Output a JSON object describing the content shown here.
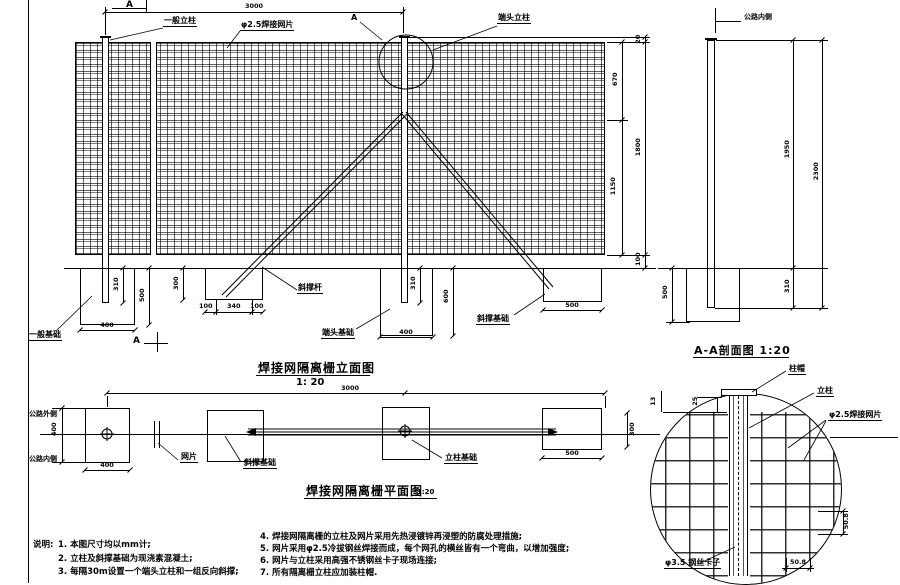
{
  "elevation": {
    "title": "焊接网隔离栅立面图",
    "scale": "1: 20",
    "span": "3000",
    "marker_a_top": "A",
    "marker_a_bottom": "A",
    "callout_a": "A",
    "post_general": "一般立柱",
    "mesh_label": "φ2.5焊接网片",
    "end_post": "端头立柱",
    "d20": "20",
    "d670": "670",
    "d1800": "1800",
    "d1150": "1150",
    "d100": "100",
    "f1_embed": "310",
    "f1_depth": "500",
    "f1_width": "400",
    "f1_label": "一般基础",
    "f2_depth": "300",
    "f2_a": "100",
    "f2_b": "340",
    "f2_c": "100",
    "brace_label": "斜撑杆",
    "f3_embed": "310",
    "f3_width": "400",
    "f3_depth": "600",
    "f3_label": "端头基础",
    "f4_width": "500",
    "f4_label": "斜撑基础"
  },
  "section": {
    "title": "A-A剖面图 1:20",
    "road_in": "公路内侧",
    "d_above": "1950",
    "d_embed": "310",
    "d_total": "2300",
    "d_fdn": "500"
  },
  "plan": {
    "title": "焊接网隔离栅平面图",
    "scale": "1:20",
    "span": "3000",
    "road_out": "公路外侧",
    "road_in": "公路内侧",
    "d_width": "400",
    "d_f1": "400",
    "d_f4": "500",
    "d_f4h": "300",
    "mesh_label": "网片",
    "fdn_brace": "斜撑基础",
    "fdn_post": "立柱基础"
  },
  "detail": {
    "cap": "柱帽",
    "post": "立柱",
    "mesh": "φ2.5焊接网片",
    "clip": "φ3.5 钢丝卡子",
    "d25": "25",
    "d13": "13",
    "s_right": "50.8",
    "s_bottom": "50.8"
  },
  "notes": {
    "heading": "说明:",
    "n1": "1. 本图尺寸均以mm计;",
    "n2": "2. 立柱及斜撑基础为现浇素混凝土;",
    "n3": "3. 每隔30m设置一个端头立柱和一组反向斜撑;",
    "n4": "4. 焊接网隔离栅的立柱及网片采用先热浸镀锌再浸塑的防腐处理措施;",
    "n5": "5. 网片采用φ2.5冷拔钢丝焊接而成，每个网孔的横丝皆有一个弯曲，以增加强度;",
    "n6": "6. 网片与立柱采用高强不锈钢丝卡子现场连接;",
    "n7": "7. 所有隔离栅立柱应加装柱帽."
  }
}
